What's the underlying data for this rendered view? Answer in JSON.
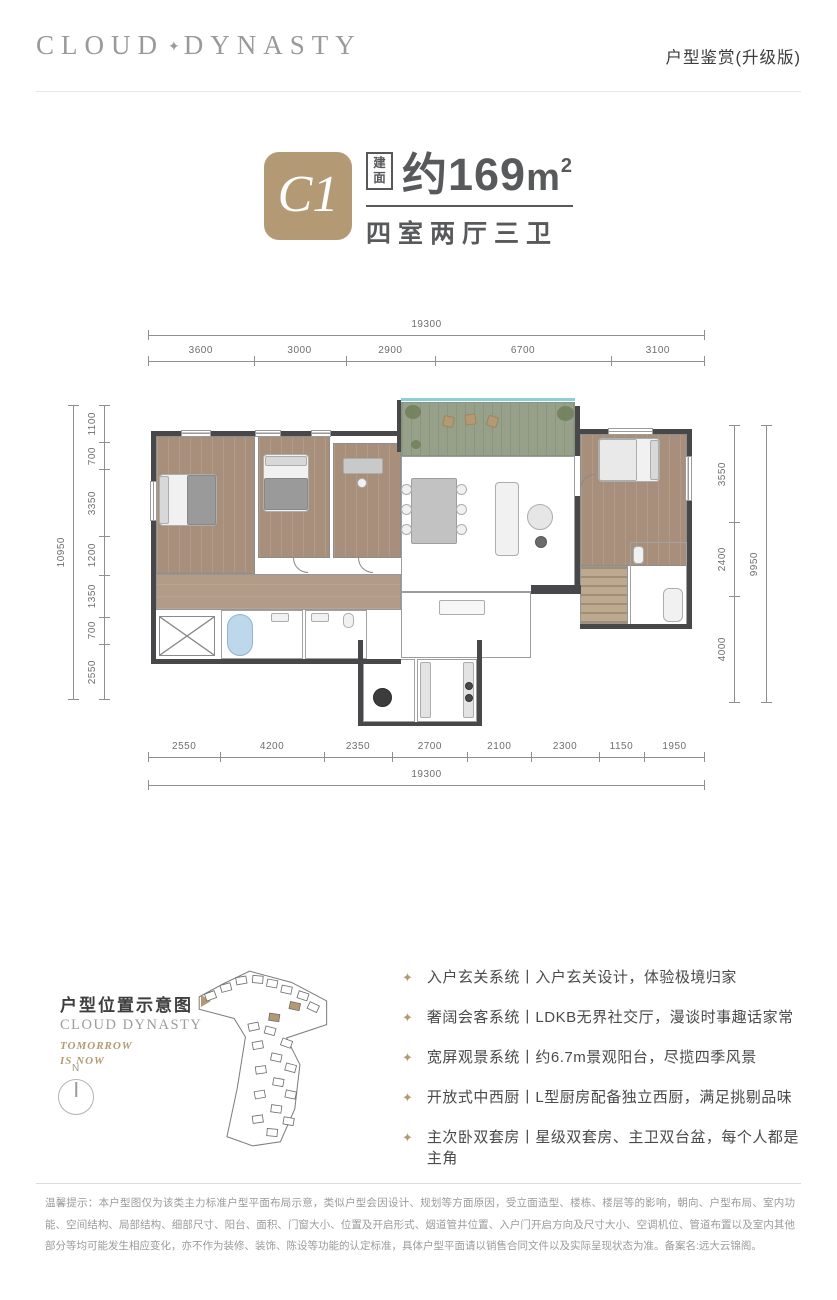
{
  "header": {
    "logo_left": "CLOUD",
    "logo_star": "✦",
    "logo_right": "DYNASTY",
    "tagline": "户型鉴赏(升级版)"
  },
  "unit": {
    "badge": "C1",
    "area_label": "建面",
    "area_value": "约169",
    "area_unit_base": "m",
    "area_unit_sup": "2",
    "rooms": "四室两厅三卫"
  },
  "floorplan": {
    "dims_top": {
      "total": "19300",
      "segments": [
        3600,
        3000,
        2900,
        6700,
        3100
      ]
    },
    "dims_bottom": {
      "total": "19300",
      "segments": [
        2550,
        4200,
        2350,
        2700,
        2100,
        2300,
        1150,
        1950
      ]
    },
    "dims_left": {
      "total": "10950",
      "segments": [
        1100,
        700,
        3350,
        1200,
        1350,
        700,
        2550
      ]
    },
    "dims_right": {
      "total": "9950",
      "segments": [
        3550,
        2400,
        4000
      ]
    }
  },
  "location": {
    "title": "户型位置示意图",
    "brand": "CLOUD DYNASTY",
    "slogan_1": "TOMORROW",
    "slogan_2": "IS NOW",
    "compass_label": "N"
  },
  "features": {
    "bullet_icon": "✦",
    "items": [
      "入户玄关系统丨入户玄关设计，体验极境归家",
      "奢阔会客系统丨LDKB无界社交厅，漫谈时事趣话家常",
      "宽屏观景系统丨约6.7m景观阳台，尽揽四季风景",
      "开放式中西厨丨L型厨房配备独立西厨，满足挑剔品味",
      "主次卧双套房丨星级双套房、主卫双台盆，每个人都是主角"
    ]
  },
  "disclaimer": "温馨提示：本户型图仅为该类主力标准户型平面布局示意，类似户型会因设计、规划等方面原因，受立面造型、楼栋、楼层等的影响，朝向、户型布局、室内功能、空间结构、局部结构、细部尺寸、阳台、面积、门窗大小、位置及开启形式、烟道管井位置、入户门开启方向及尺寸大小、空调机位、管道布置以及室内其他部分等均可能发生相应变化，亦不作为装修、装饰、陈设等功能的认定标准，具体户型平面请以销售合同文件以及实际呈现状态为准。备案名:远大云锦阁。",
  "colors": {
    "accent": "#b49a74",
    "text_dark": "#58595b",
    "wall": "#48484a"
  }
}
